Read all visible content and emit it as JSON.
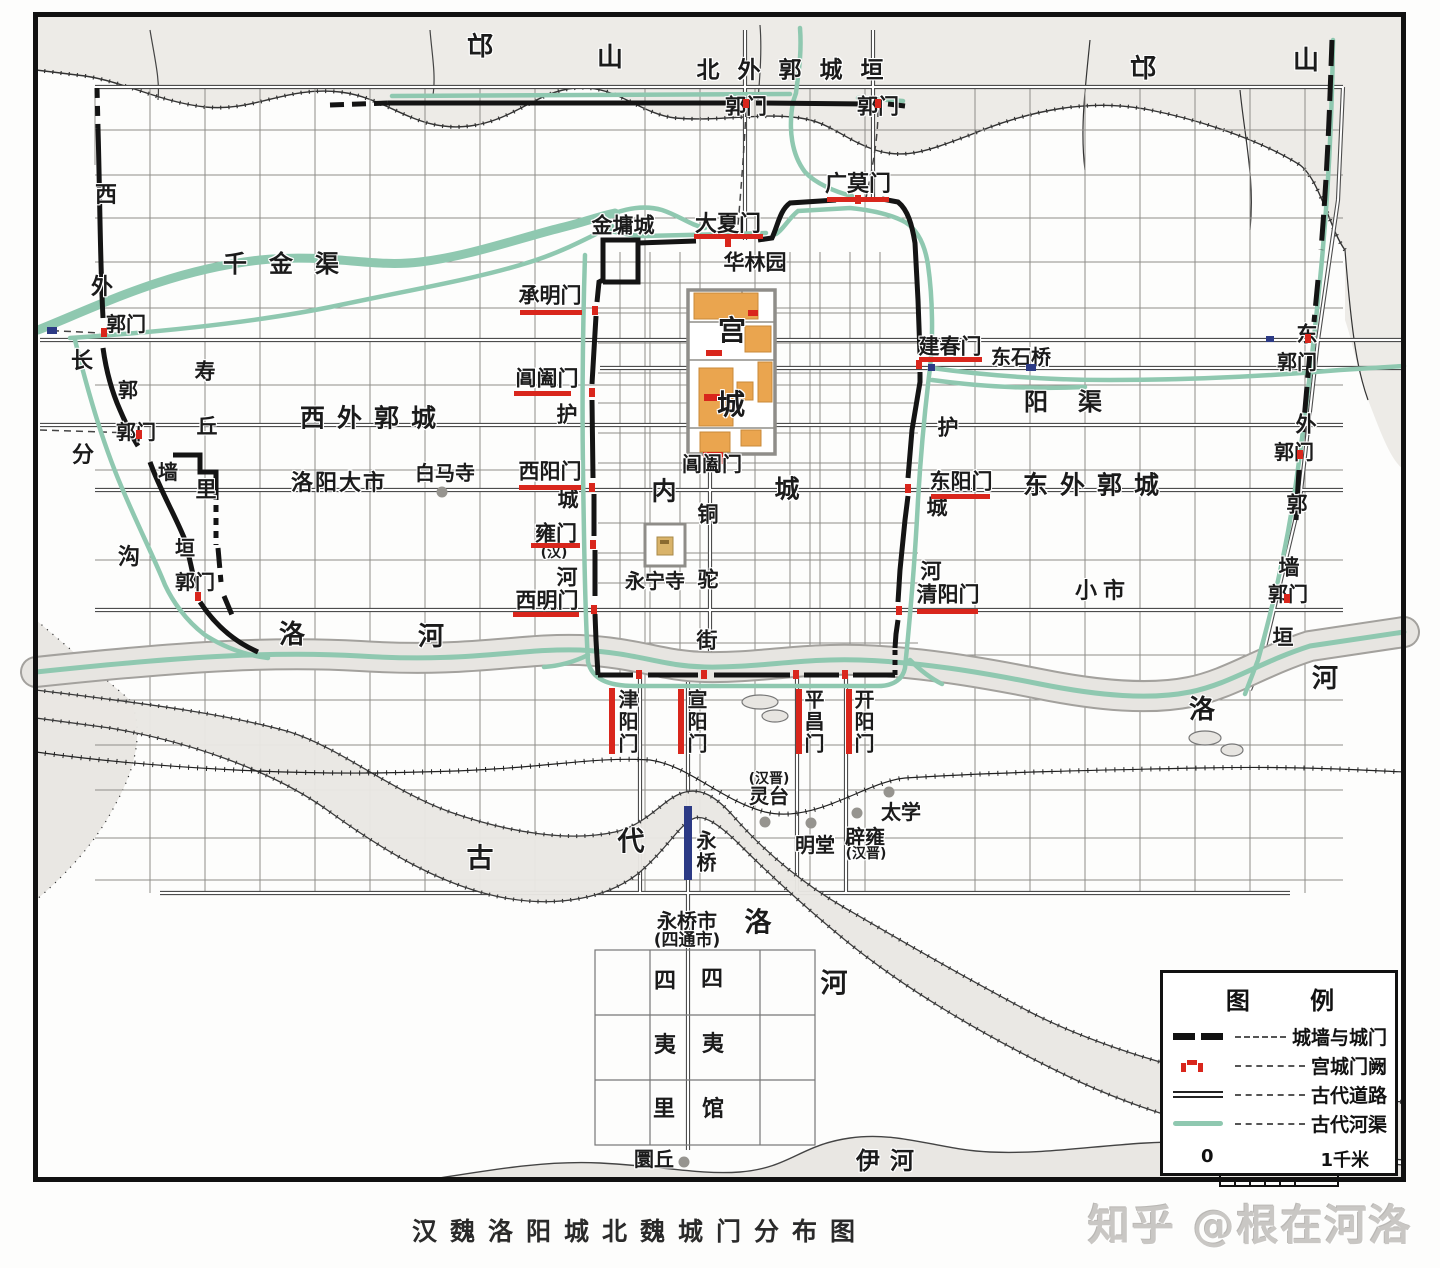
{
  "title": "汉魏洛阳城北魏城门分布图",
  "watermark": "知乎 @根在河洛",
  "legend": {
    "title": "图 例",
    "items": [
      {
        "symbol": "wall-icon",
        "label": "城墙与城门"
      },
      {
        "symbol": "palace-gate-icon",
        "label": "宫城门阙"
      },
      {
        "symbol": "road-icon",
        "label": "古代道路"
      },
      {
        "symbol": "river-icon",
        "label": "古代河渠"
      }
    ],
    "scale": {
      "start": "0",
      "end": "1千米"
    }
  },
  "colors": {
    "gate_red": "#d9261c",
    "river_teal": "#8fc8b0",
    "bridge_blue": "#2c3a85",
    "building_orange": "#eaa54f"
  },
  "map": {
    "labels": [
      {
        "text": "邙",
        "x": 480,
        "y": 47,
        "fs": 26
      },
      {
        "text": "山",
        "x": 610,
        "y": 58,
        "fs": 26
      },
      {
        "text": "北外郭城垣",
        "x": 799,
        "y": 71,
        "fs": 23,
        "ls": 18
      },
      {
        "text": "郭门",
        "x": 746,
        "y": 107,
        "fs": 21
      },
      {
        "text": "郭门",
        "x": 878,
        "y": 107,
        "fs": 21
      },
      {
        "text": "邙",
        "x": 1143,
        "y": 69,
        "fs": 26
      },
      {
        "text": "山",
        "x": 1306,
        "y": 61,
        "fs": 26
      },
      {
        "text": "广莫门",
        "x": 858,
        "y": 185,
        "fs": 22
      },
      {
        "text": "金墉城",
        "x": 623,
        "y": 226,
        "fs": 21
      },
      {
        "text": "大夏门",
        "x": 728,
        "y": 225,
        "fs": 22
      },
      {
        "text": "华林园",
        "x": 755,
        "y": 263,
        "fs": 21
      },
      {
        "text": "千金渠",
        "x": 292,
        "y": 264,
        "fs": 24,
        "ls": 22
      },
      {
        "text": "承明门",
        "x": 550,
        "y": 296,
        "fs": 21
      },
      {
        "text": "西",
        "x": 106,
        "y": 196,
        "fs": 22
      },
      {
        "text": "外",
        "x": 102,
        "y": 288,
        "fs": 22
      },
      {
        "text": "郭门",
        "x": 126,
        "y": 324,
        "fs": 20
      },
      {
        "text": "长",
        "x": 82,
        "y": 362,
        "fs": 22
      },
      {
        "text": "郭",
        "x": 128,
        "y": 390,
        "fs": 20
      },
      {
        "text": "郭门",
        "x": 136,
        "y": 432,
        "fs": 20
      },
      {
        "text": "寿",
        "x": 205,
        "y": 372,
        "fs": 21
      },
      {
        "text": "丘",
        "x": 207,
        "y": 427,
        "fs": 21
      },
      {
        "text": "西外郭城",
        "x": 374,
        "y": 418,
        "fs": 25,
        "ls": 12
      },
      {
        "text": "分",
        "x": 83,
        "y": 456,
        "fs": 22
      },
      {
        "text": "墙",
        "x": 168,
        "y": 472,
        "fs": 20
      },
      {
        "text": "里",
        "x": 206,
        "y": 490,
        "fs": 21
      },
      {
        "text": "洛阳大市",
        "x": 339,
        "y": 484,
        "fs": 22,
        "ls": 2
      },
      {
        "text": "白马寺",
        "x": 445,
        "y": 473,
        "fs": 20
      },
      {
        "text": "沟",
        "x": 129,
        "y": 558,
        "fs": 22
      },
      {
        "text": "垣",
        "x": 185,
        "y": 548,
        "fs": 20
      },
      {
        "text": "郭门",
        "x": 195,
        "y": 582,
        "fs": 20
      },
      {
        "text": "宫",
        "x": 732,
        "y": 331,
        "fs": 28
      },
      {
        "text": "城",
        "x": 731,
        "y": 405,
        "fs": 28
      },
      {
        "text": "阊阖门",
        "x": 547,
        "y": 379,
        "fs": 21
      },
      {
        "text": "护",
        "x": 567,
        "y": 415,
        "fs": 21
      },
      {
        "text": "西阳门",
        "x": 550,
        "y": 472,
        "fs": 21
      },
      {
        "text": "城",
        "x": 568,
        "y": 500,
        "fs": 21
      },
      {
        "text": "雍门",
        "x": 556,
        "y": 534,
        "fs": 21
      },
      {
        "text": "(汉)",
        "x": 554,
        "y": 553,
        "fs": 14
      },
      {
        "text": "河",
        "x": 567,
        "y": 578,
        "fs": 21
      },
      {
        "text": "西明门",
        "x": 547,
        "y": 601,
        "fs": 21
      },
      {
        "text": "内",
        "x": 664,
        "y": 491,
        "fs": 25
      },
      {
        "text": "城",
        "x": 787,
        "y": 489,
        "fs": 25
      },
      {
        "text": "阊阖门",
        "x": 712,
        "y": 464,
        "fs": 20
      },
      {
        "text": "铜",
        "x": 708,
        "y": 515,
        "fs": 21
      },
      {
        "text": "驼",
        "x": 708,
        "y": 580,
        "fs": 21
      },
      {
        "text": "街",
        "x": 707,
        "y": 641,
        "fs": 21
      },
      {
        "text": "永宁寺",
        "x": 655,
        "y": 581,
        "fs": 20
      },
      {
        "text": "建春门",
        "x": 950,
        "y": 347,
        "fs": 21
      },
      {
        "text": "东石桥",
        "x": 1021,
        "y": 357,
        "fs": 20
      },
      {
        "text": "阳渠",
        "x": 1078,
        "y": 402,
        "fs": 24,
        "ls": 30
      },
      {
        "text": "护",
        "x": 948,
        "y": 428,
        "fs": 21
      },
      {
        "text": "东阳门",
        "x": 961,
        "y": 482,
        "fs": 21
      },
      {
        "text": "东外郭城",
        "x": 1097,
        "y": 485,
        "fs": 25,
        "ls": 12
      },
      {
        "text": "城",
        "x": 937,
        "y": 508,
        "fs": 21
      },
      {
        "text": "河",
        "x": 931,
        "y": 572,
        "fs": 21
      },
      {
        "text": "清阳门",
        "x": 948,
        "y": 595,
        "fs": 21
      },
      {
        "text": "小市",
        "x": 1103,
        "y": 592,
        "fs": 22,
        "ls": 6
      },
      {
        "text": "东",
        "x": 1307,
        "y": 335,
        "fs": 21
      },
      {
        "text": "郭门",
        "x": 1297,
        "y": 362,
        "fs": 20
      },
      {
        "text": "外",
        "x": 1306,
        "y": 425,
        "fs": 21
      },
      {
        "text": "郭门",
        "x": 1294,
        "y": 452,
        "fs": 20
      },
      {
        "text": "郭",
        "x": 1297,
        "y": 505,
        "fs": 21
      },
      {
        "text": "墙",
        "x": 1289,
        "y": 568,
        "fs": 21
      },
      {
        "text": "郭门",
        "x": 1288,
        "y": 594,
        "fs": 20
      },
      {
        "text": "垣",
        "x": 1283,
        "y": 638,
        "fs": 21
      },
      {
        "text": "洛",
        "x": 292,
        "y": 635,
        "fs": 26
      },
      {
        "text": "河",
        "x": 431,
        "y": 637,
        "fs": 26
      },
      {
        "text": "洛",
        "x": 1202,
        "y": 710,
        "fs": 26
      },
      {
        "text": "河",
        "x": 1325,
        "y": 679,
        "fs": 26
      },
      {
        "text": "津阳门",
        "x": 627,
        "y": 722,
        "fs": 20,
        "v": true
      },
      {
        "text": "宣阳门",
        "x": 696,
        "y": 722,
        "fs": 20,
        "v": true
      },
      {
        "text": "平昌门",
        "x": 813,
        "y": 722,
        "fs": 20,
        "v": true
      },
      {
        "text": "开阳门",
        "x": 863,
        "y": 722,
        "fs": 20,
        "v": true
      },
      {
        "text": "(汉晋)",
        "x": 769,
        "y": 779,
        "fs": 14
      },
      {
        "text": "灵台",
        "x": 769,
        "y": 796,
        "fs": 20
      },
      {
        "text": "明堂",
        "x": 815,
        "y": 845,
        "fs": 20
      },
      {
        "text": "辟雍",
        "x": 865,
        "y": 837,
        "fs": 20
      },
      {
        "text": "(汉晋)",
        "x": 866,
        "y": 854,
        "fs": 14
      },
      {
        "text": "太学",
        "x": 901,
        "y": 812,
        "fs": 20
      },
      {
        "text": "古",
        "x": 480,
        "y": 859,
        "fs": 27
      },
      {
        "text": "代",
        "x": 631,
        "y": 842,
        "fs": 27
      },
      {
        "text": "洛",
        "x": 758,
        "y": 923,
        "fs": 27
      },
      {
        "text": "河",
        "x": 834,
        "y": 984,
        "fs": 27
      },
      {
        "text": "永桥",
        "x": 705,
        "y": 852,
        "fs": 20,
        "v": true
      },
      {
        "text": "永桥市",
        "x": 687,
        "y": 921,
        "fs": 20
      },
      {
        "text": "(四通市)",
        "x": 687,
        "y": 941,
        "fs": 17
      },
      {
        "text": "四",
        "x": 665,
        "y": 982,
        "fs": 22
      },
      {
        "text": "四",
        "x": 712,
        "y": 980,
        "fs": 22
      },
      {
        "text": "夷",
        "x": 665,
        "y": 1046,
        "fs": 22
      },
      {
        "text": "夷",
        "x": 713,
        "y": 1045,
        "fs": 22
      },
      {
        "text": "里",
        "x": 664,
        "y": 1110,
        "fs": 22
      },
      {
        "text": "馆",
        "x": 713,
        "y": 1110,
        "fs": 22
      },
      {
        "text": "圜丘",
        "x": 654,
        "y": 1159,
        "fs": 20
      },
      {
        "text": "伊河",
        "x": 890,
        "y": 1161,
        "fs": 24,
        "ls": 10
      }
    ],
    "gate_marks": [
      {
        "x": 520,
        "y": 310,
        "w": 62,
        "h": 5
      },
      {
        "x": 514,
        "y": 391,
        "w": 57,
        "h": 5
      },
      {
        "x": 519,
        "y": 485,
        "w": 62,
        "h": 5
      },
      {
        "x": 531,
        "y": 543,
        "w": 49,
        "h": 5
      },
      {
        "x": 513,
        "y": 612,
        "w": 66,
        "h": 5
      },
      {
        "x": 694,
        "y": 234,
        "w": 69,
        "h": 5
      },
      {
        "x": 827,
        "y": 197,
        "w": 62,
        "h": 5
      },
      {
        "x": 919,
        "y": 357,
        "w": 63,
        "h": 5
      },
      {
        "x": 931,
        "y": 494,
        "w": 59,
        "h": 5
      },
      {
        "x": 917,
        "y": 609,
        "w": 61,
        "h": 5
      },
      {
        "x": 609,
        "y": 688,
        "w": 6,
        "h": 66
      },
      {
        "x": 678,
        "y": 689,
        "w": 6,
        "h": 65
      },
      {
        "x": 796,
        "y": 689,
        "w": 6,
        "h": 65
      },
      {
        "x": 846,
        "y": 689,
        "w": 6,
        "h": 65
      },
      {
        "x": 684,
        "y": 806,
        "w": 8,
        "h": 74,
        "color": "#2c3a85"
      },
      {
        "x": 743,
        "y": 99,
        "w": 6,
        "h": 9
      },
      {
        "x": 875,
        "y": 99,
        "w": 6,
        "h": 9
      },
      {
        "x": 725,
        "y": 238,
        "w": 6,
        "h": 9
      },
      {
        "x": 855,
        "y": 195,
        "w": 6,
        "h": 9
      },
      {
        "x": 916,
        "y": 360,
        "w": 6,
        "h": 9
      },
      {
        "x": 905,
        "y": 484,
        "w": 6,
        "h": 9
      },
      {
        "x": 896,
        "y": 606,
        "w": 6,
        "h": 9
      },
      {
        "x": 592,
        "y": 306,
        "w": 6,
        "h": 9
      },
      {
        "x": 589,
        "y": 388,
        "w": 6,
        "h": 9
      },
      {
        "x": 589,
        "y": 483,
        "w": 6,
        "h": 9
      },
      {
        "x": 590,
        "y": 540,
        "w": 6,
        "h": 9
      },
      {
        "x": 591,
        "y": 605,
        "w": 6,
        "h": 9
      },
      {
        "x": 636,
        "y": 670,
        "w": 6,
        "h": 9
      },
      {
        "x": 701,
        "y": 670,
        "w": 6,
        "h": 9
      },
      {
        "x": 793,
        "y": 670,
        "w": 6,
        "h": 9
      },
      {
        "x": 842,
        "y": 670,
        "w": 6,
        "h": 9
      },
      {
        "x": 101,
        "y": 328,
        "w": 6,
        "h": 9
      },
      {
        "x": 136,
        "y": 430,
        "w": 6,
        "h": 9
      },
      {
        "x": 195,
        "y": 592,
        "w": 6,
        "h": 9
      },
      {
        "x": 1305,
        "y": 334,
        "w": 6,
        "h": 9
      },
      {
        "x": 1297,
        "y": 450,
        "w": 6,
        "h": 9
      },
      {
        "x": 1284,
        "y": 594,
        "w": 6,
        "h": 9
      },
      {
        "x": 1026,
        "y": 364,
        "w": 10,
        "h": 7,
        "color": "#2c3a85"
      },
      {
        "x": 47,
        "y": 327,
        "w": 10,
        "h": 7,
        "color": "#2c3a85"
      },
      {
        "x": 928,
        "y": 364,
        "w": 7,
        "h": 7,
        "color": "#2c3a85"
      },
      {
        "x": 1266,
        "y": 336,
        "w": 8,
        "h": 6,
        "color": "#2c3a85"
      }
    ],
    "dots": [
      {
        "name": "baimasi-dot",
        "x": 442,
        "y": 492
      },
      {
        "name": "lingtai-dot",
        "x": 765,
        "y": 822
      },
      {
        "name": "mingtang-dot",
        "x": 811,
        "y": 823
      },
      {
        "name": "biyong-dot",
        "x": 857,
        "y": 813
      },
      {
        "name": "taixue-dot",
        "x": 889,
        "y": 792
      },
      {
        "name": "huanqiu-dot",
        "x": 684,
        "y": 1162
      }
    ]
  }
}
